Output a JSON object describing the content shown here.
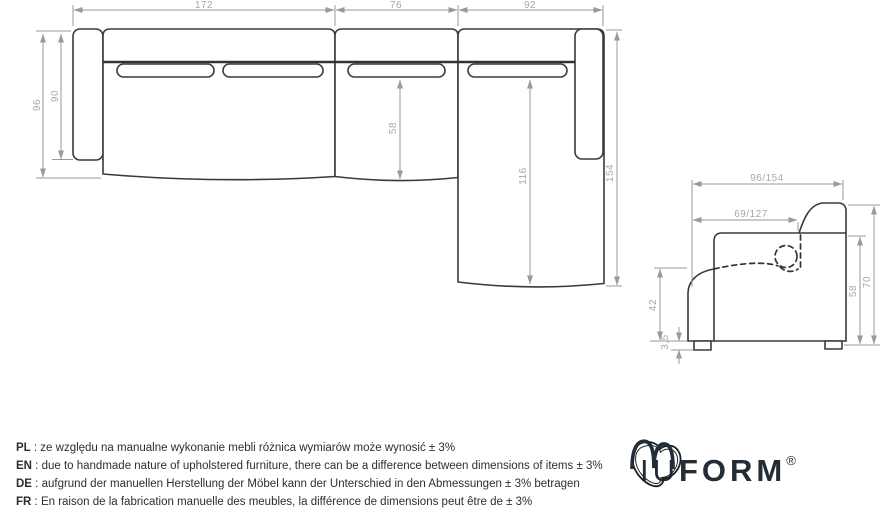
{
  "top_view": {
    "width_main": "172",
    "width_mid": "76",
    "width_chaise": "92",
    "depth_total": "96",
    "depth_arm": "90",
    "seat_depth": "58",
    "chaise_inner": "116",
    "chaise_total": "154"
  },
  "side_view": {
    "depth": "96/154",
    "seat_depth": "69/127",
    "seat_height": "42",
    "leg_height": "3,5",
    "back_height": "58",
    "height": "70"
  },
  "notes": [
    {
      "lang": "PL",
      "sep": " : ",
      "text": "ze względu na manualne wykonanie mebli różnica wymiarów może wynosić ± 3%"
    },
    {
      "lang": "EN",
      "sep": " : ",
      "text": "due to handmade nature of upholstered furniture, there can be a difference between dimensions of items ± 3%"
    },
    {
      "lang": "DE",
      "sep": " : ",
      "text": "aufgrund der manuellen Herstellung der Möbel kann der Unterschied in den Abmessungen ± 3% betragen"
    },
    {
      "lang": "FR",
      "sep": " : ",
      "text": "En raison de la fabrication manuelle des meubles, la différence de dimensions peut être de ± 3%"
    }
  ],
  "logo": {
    "iu": "IU",
    "form": "FORM",
    "registered": "®"
  }
}
